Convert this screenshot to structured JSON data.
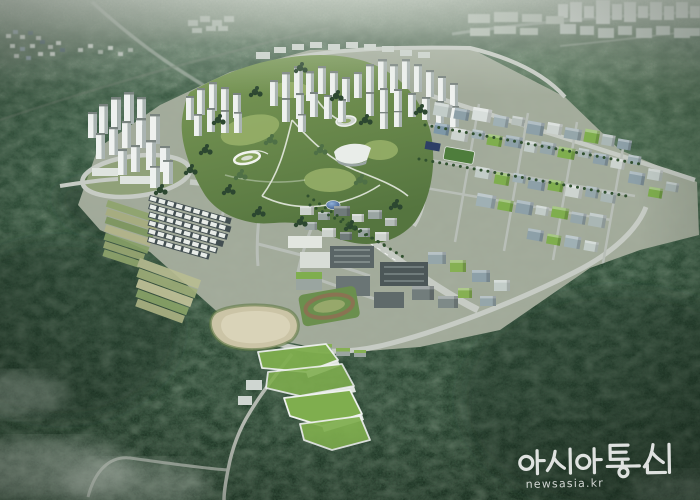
{
  "scene": {
    "kind": "aerial-architectural-rendering",
    "regions": [
      "forested-mountains",
      "distant-city",
      "hillside-village",
      "apartment-towers",
      "central-park",
      "business-district",
      "industrial-blocks",
      "townhouse-rows",
      "retention-pond",
      "sports-field",
      "eco-roof-complex",
      "fog-patches"
    ]
  },
  "watermark": {
    "agency_name": "아시아통신",
    "url": "newsasia.kr",
    "color": "#ffffff"
  },
  "palette": {
    "forest_dark": "#22392a",
    "forest_mid": "#31513a",
    "haze": "#dfe5dd",
    "road": "#c6cbc4",
    "road_minor": "#b8beb7",
    "building_white": "#eef1ef",
    "building_shade": "#aab4b2",
    "glass_blue": "#8da0a8",
    "park_green": "#6d8c4e",
    "meadow": "#9cb46c",
    "green_roof": "#7fae4e",
    "pond": "#cbc4a6",
    "pond_inner": "#d9d3b8",
    "sports_field": "#4e7d3c",
    "solar_blue": "#2e3f66",
    "dome_blue": "#5b7cae",
    "tree_dark": "#2c4730"
  }
}
